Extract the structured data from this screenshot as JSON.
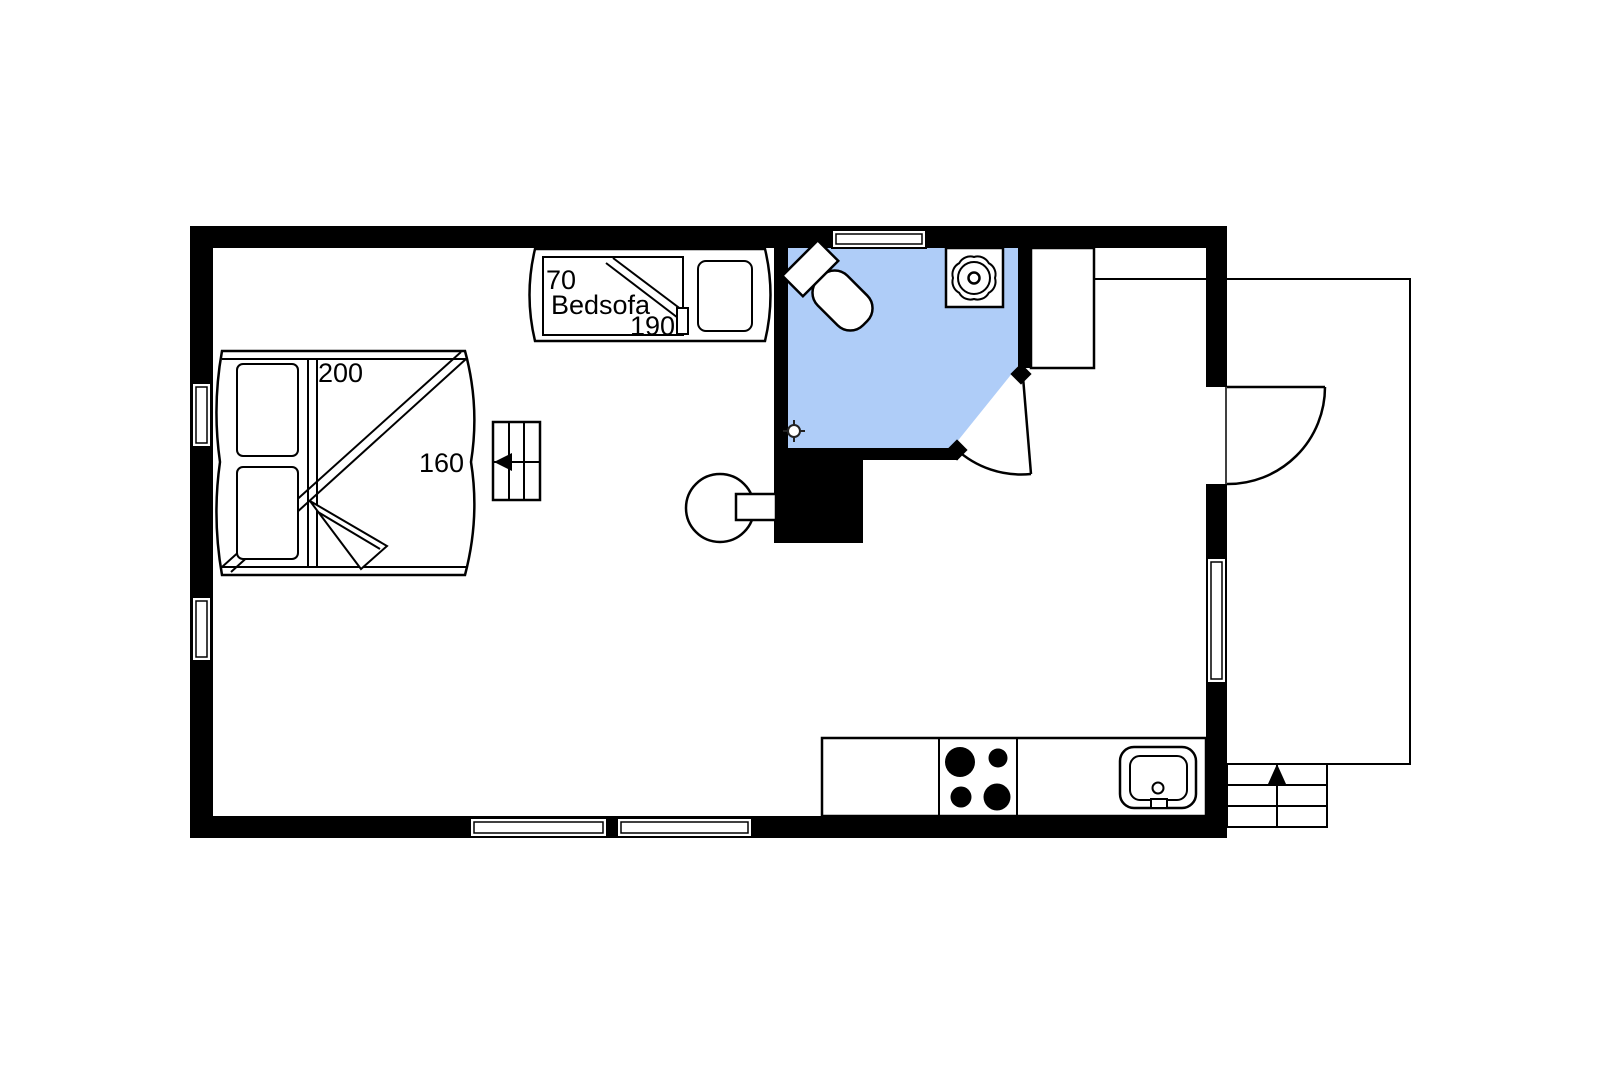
{
  "floor_plan": {
    "labels": {
      "bedsofa_width_cm": "70",
      "bedsofa_name": "Bedsofa",
      "bedsofa_length_cm": "190",
      "bed_length_cm": "200",
      "bed_width_cm": "160"
    },
    "colors": {
      "bathroom_floor": "#AFCDF8",
      "walls": "#000000",
      "lines": "#000000",
      "background": "#FFFFFF"
    },
    "rooms": {
      "main_room": "bedroom-living-area",
      "bathroom": "bathroom",
      "kitchen": "kitchen-corner",
      "outside": "terrace-with-steps"
    },
    "fixtures": [
      "double-bed",
      "bedsofa",
      "loft-ladder",
      "round-table",
      "toilet",
      "shower-drain",
      "floor-drain",
      "wardrobe-cabinet",
      "kitchen-counter",
      "stove-4-burners",
      "kitchen-sink",
      "entrance-door",
      "bathroom-door",
      "entrance-steps",
      "window-left-1",
      "window-left-2",
      "window-top",
      "window-bottom-1",
      "window-bottom-2",
      "window-right"
    ]
  }
}
